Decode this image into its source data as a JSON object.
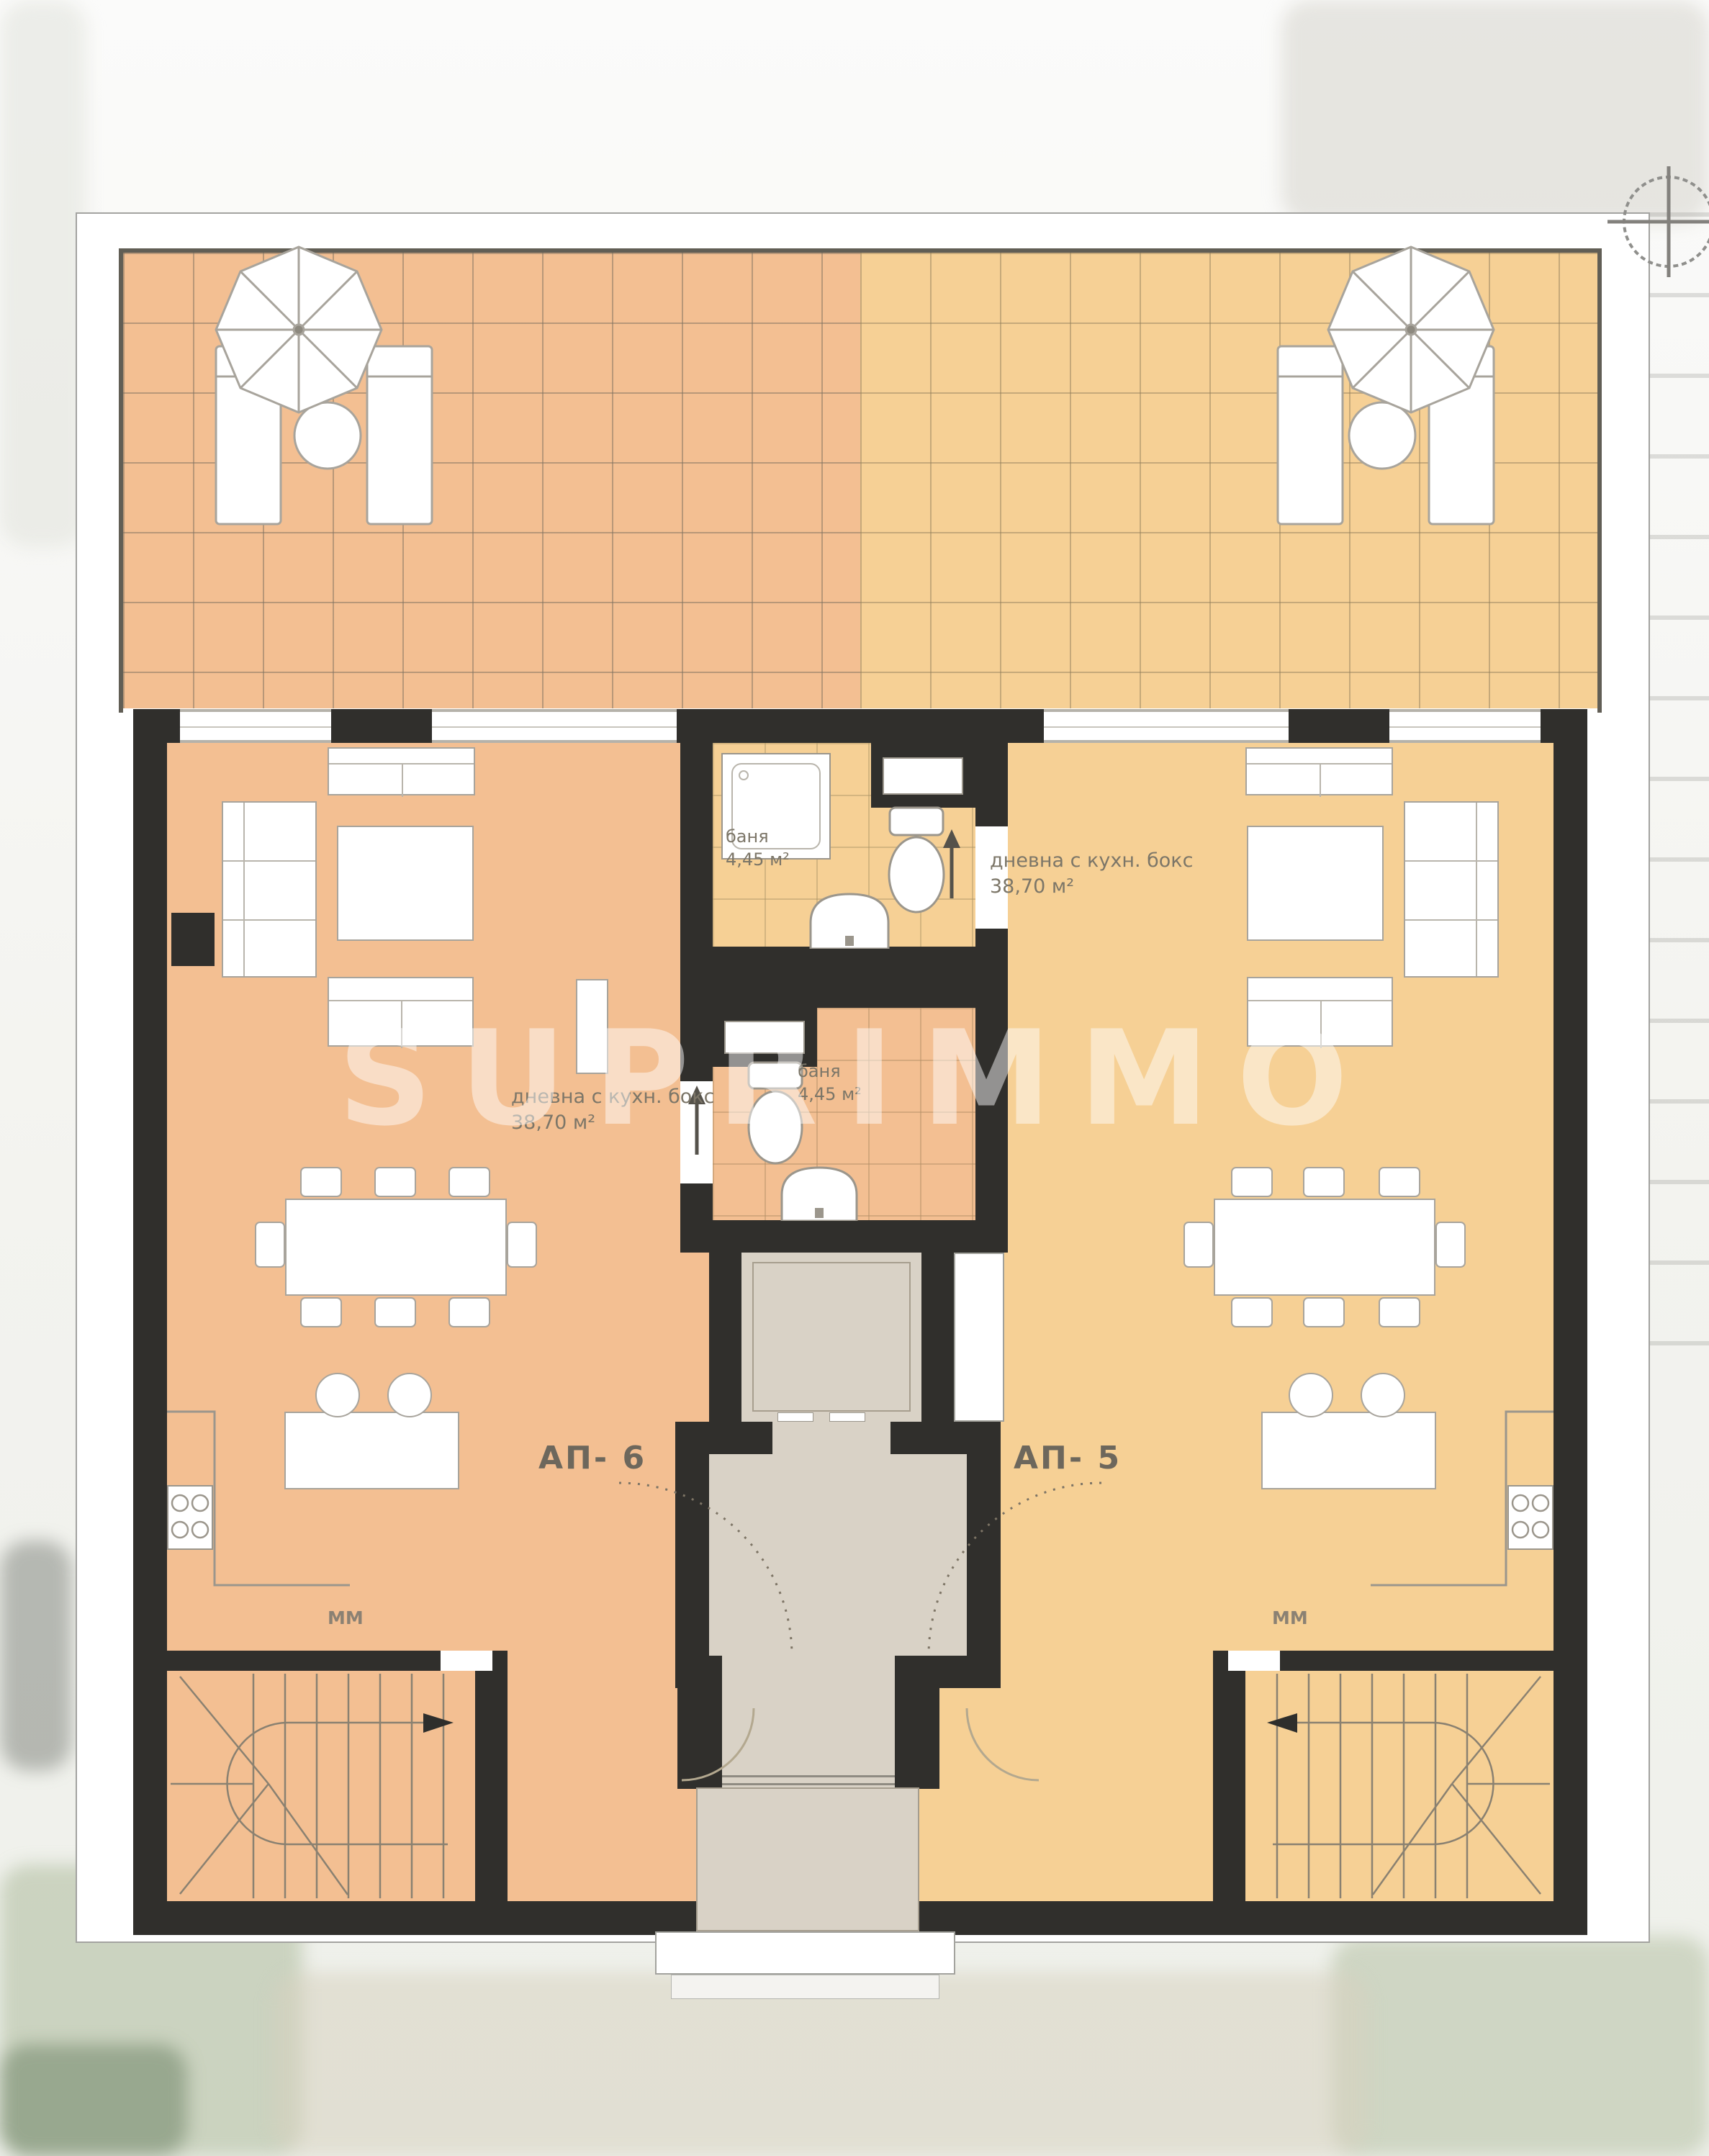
{
  "floor_plan": {
    "watermark_text": "SUPRIMMO",
    "icons": {
      "compass": "crosshair-compass-icon",
      "umbrella": "parasol-top-view",
      "stair_direction_left_room": "arrow-right",
      "stair_direction_right_room": "arrow-left",
      "bathroom_door": "arrow-up"
    },
    "colors": {
      "left_apartment_floor": "#f3bf92",
      "right_apartment_floor": "#f6d095",
      "walls": "#302f2c",
      "core_floor": "#d9d2c6",
      "sheet": "#ffffff"
    },
    "apartments": [
      {
        "id": "АП- 6",
        "living_line1": "дневна с кухн. бокс",
        "living_line2": "38,70 м²",
        "bath_line1": "баня",
        "bath_line2": "4,45 м²",
        "kitchen_mark": "ММ"
      },
      {
        "id": "АП- 5",
        "living_line1": "дневна с кухн. бокс",
        "living_line2": "38,70 м²",
        "bath_line1": "баня",
        "bath_line2": "4,45 м²",
        "kitchen_mark": "ММ"
      }
    ]
  }
}
